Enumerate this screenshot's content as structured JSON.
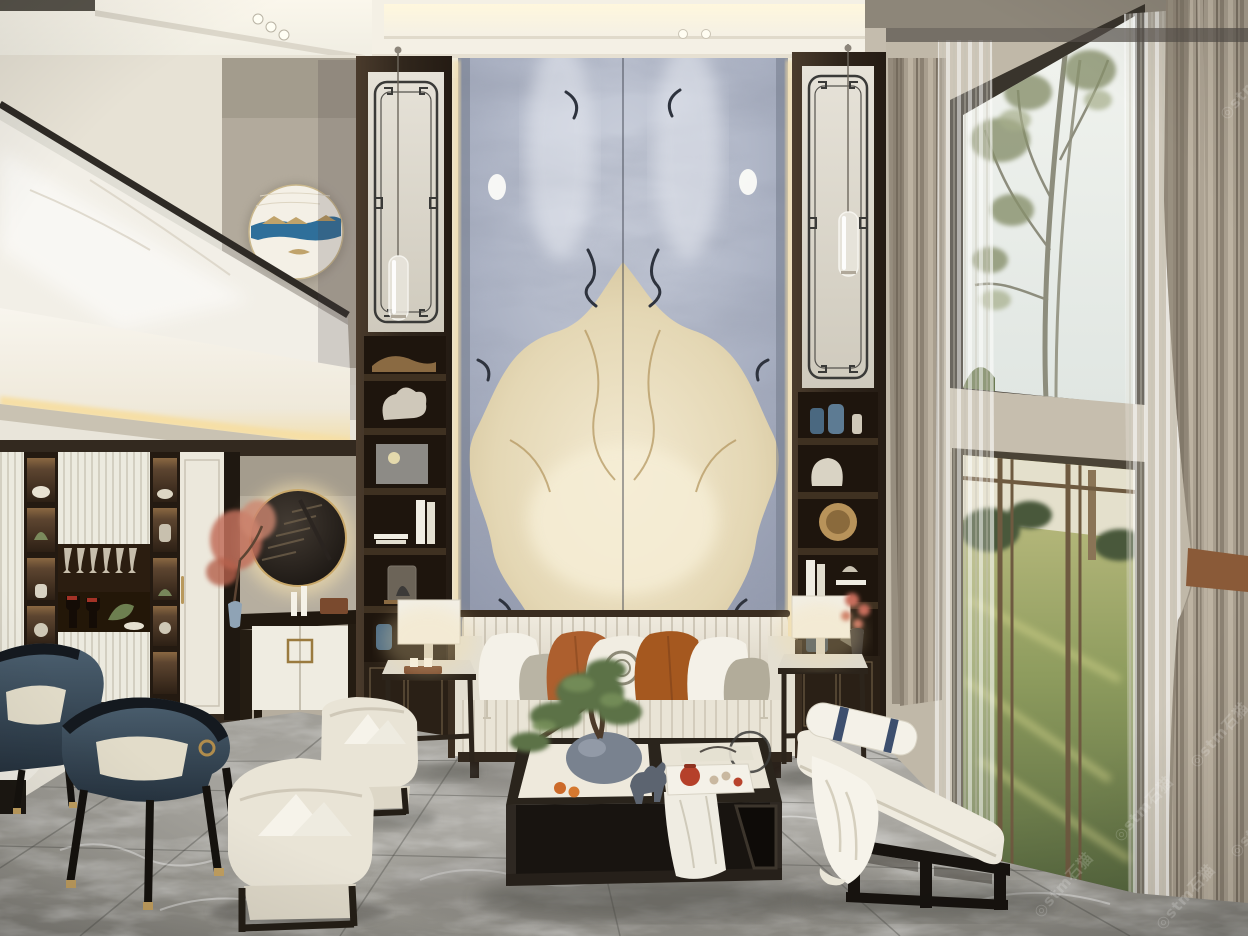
{
  "type": "interior-photograph",
  "description": "Double-height new-Chinese-style living room: book-matched blue-grey marble feature wall with warm backlit edges, flanked by dark wood display columns with fretwork panels and glass pendant lights; cream channel-tufted sofa with terracotta pillows; dark coffee table with bonsai, tea set and horse figurine; barrel armchairs; navy dining chairs and wine display cabinet at left under a mezzanine with glass railing and round blue-ribbon wall art; floor-to-ceiling windows at right with sheer and taupe drapes overlooking a eucalyptus tree and sunlit lawn; grey marble tile floor",
  "watermark": {
    "label": "◎stm石猫"
  },
  "palette": {
    "ceiling": "#f2eee4",
    "cove_glow": "#fff6dc",
    "wall_cream": "#e6e1d4",
    "wall_accent_grey": "#b2aa9c",
    "marble_blue_grey": "#9ba3b6",
    "marble_cream": "#e9dfc2",
    "wood_dark": "#382c21",
    "backlight_gold": "#ecd6a0",
    "sofa_cream": "#eae5d8",
    "pillow_terracotta": "#ad5f2e",
    "pillow_navy_stripe": "#3d4f6e",
    "chair_teal": "#3c4e5e",
    "drape_taupe": "#a69c8c",
    "sheer_white": "#e8e5de",
    "floor_grey": "#9a9894",
    "lawn_green": "#8e9c5e",
    "art_ribbon_blue": "#2f6f9a",
    "brass": "#c0a068",
    "tieback_leather": "#8a5a38"
  }
}
